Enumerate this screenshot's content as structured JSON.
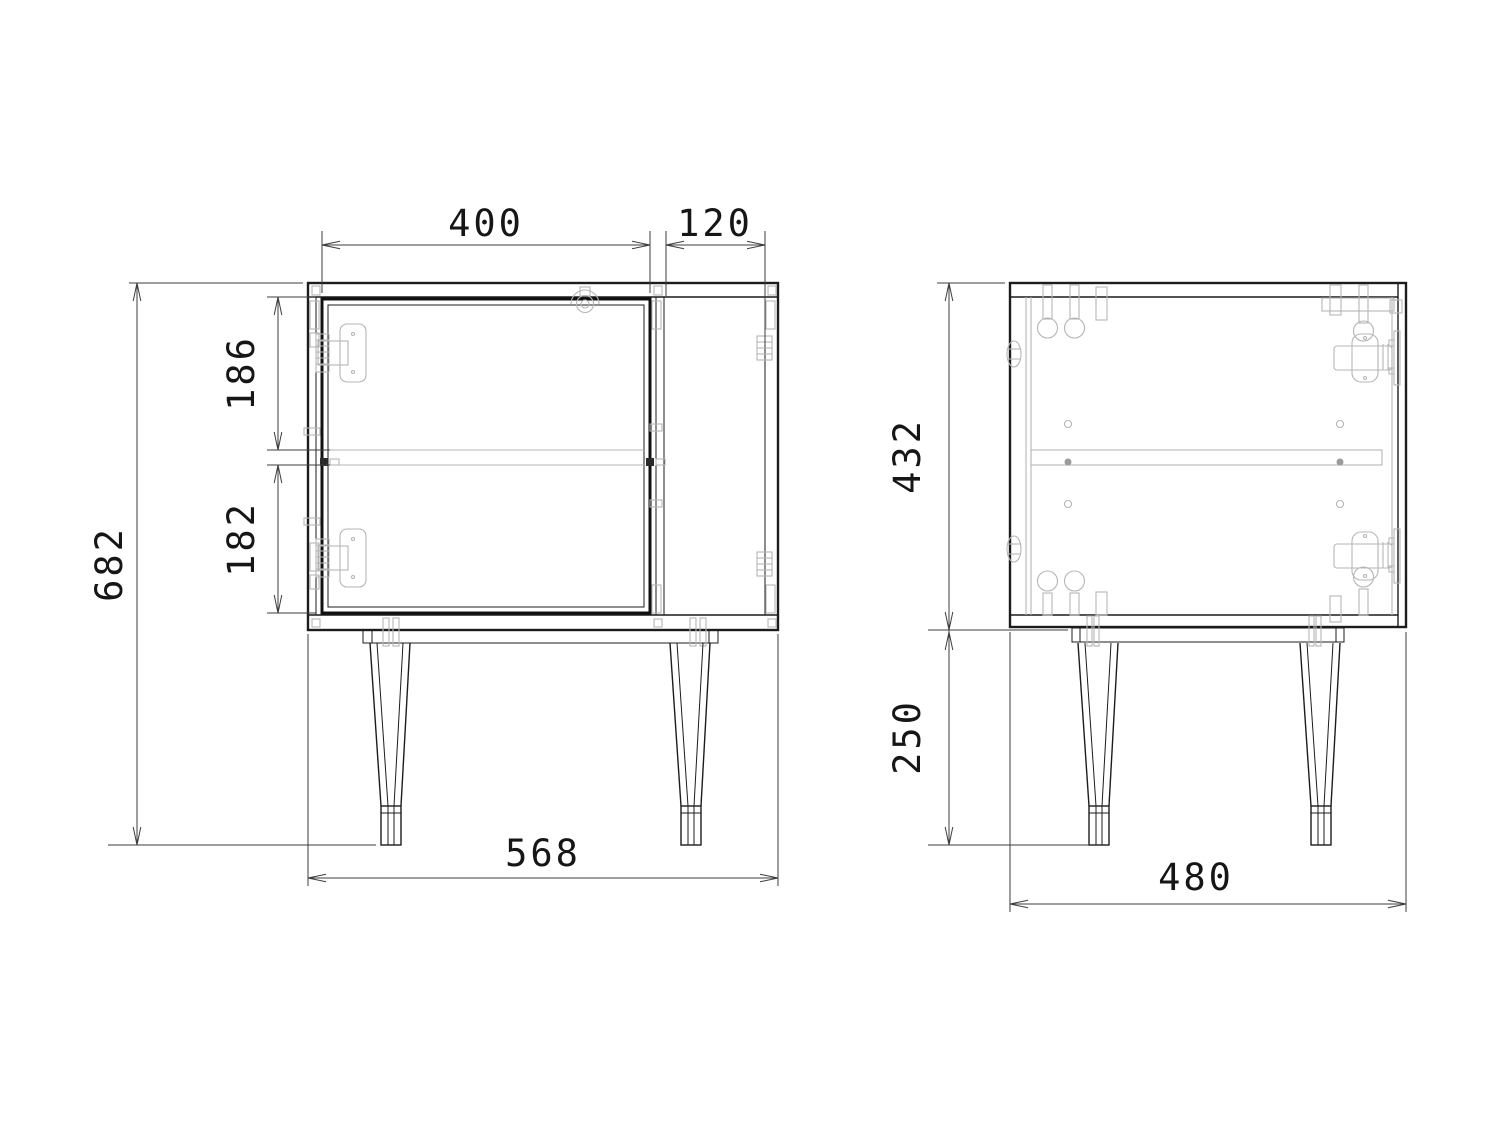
{
  "page": {
    "background_color": "#ffffff"
  },
  "drawing": {
    "kind": "furniture-technical-drawing",
    "colors": {
      "visible_line": "#1c1c1c",
      "hidden_line": "#b6b6b6",
      "dimension_line": "#3e3e3e",
      "text": "#161616"
    }
  },
  "dimensions": {
    "door_width": "400",
    "open_section_width": "120",
    "upper_compartment_height": "186",
    "lower_compartment_height": "182",
    "overall_height": "682",
    "overall_width": "568",
    "carcass_height": "432",
    "leg_height": "250",
    "overall_depth": "480"
  }
}
